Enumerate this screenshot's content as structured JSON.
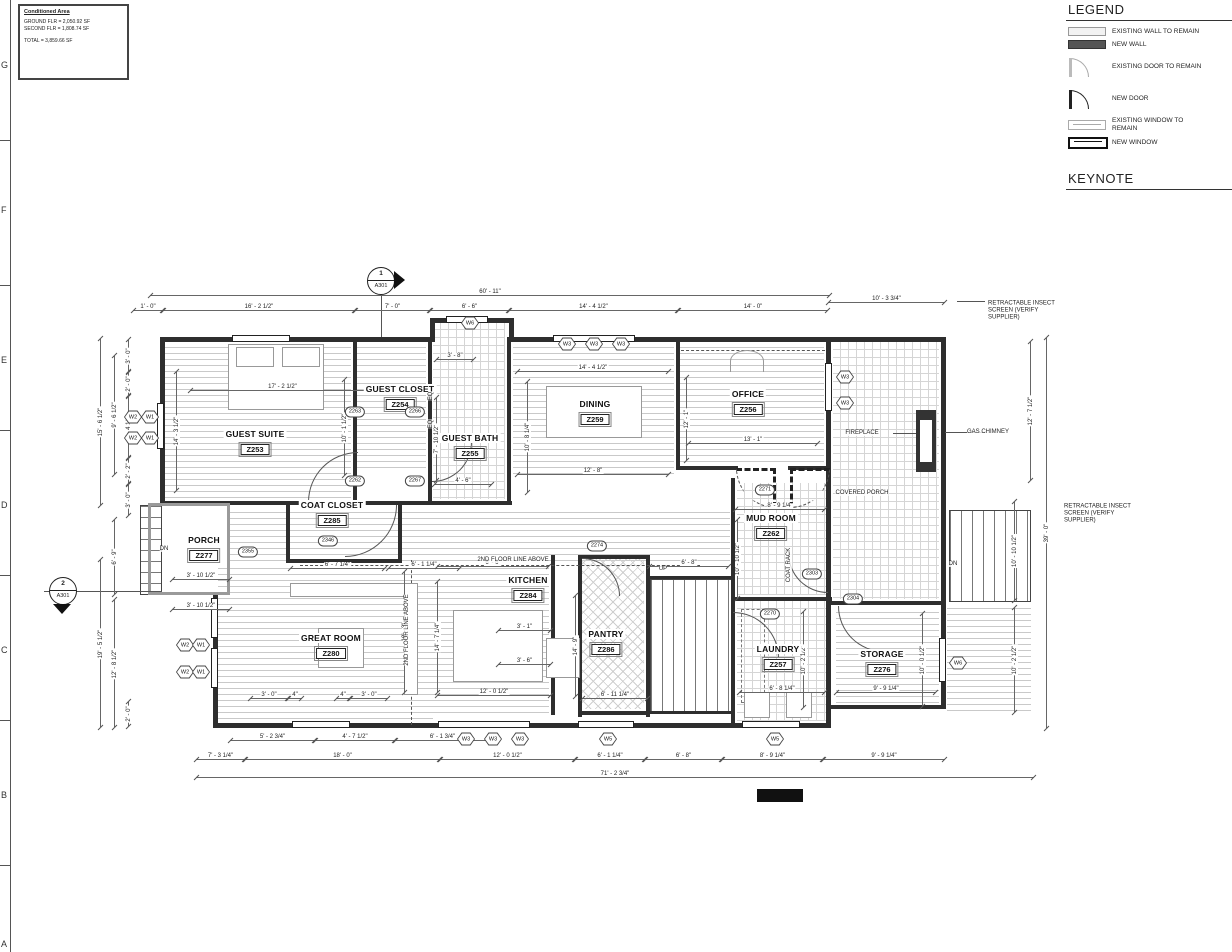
{
  "sheet": {
    "grid_letters": [
      "G",
      "F",
      "E",
      "D",
      "C",
      "B",
      "A"
    ],
    "conditioned_area": {
      "title": "Conditioned Area",
      "lines": [
        "GROUND FLR = 2,050.92 SF",
        "SECOND FLR = 1,808.74 SF"
      ],
      "total": "TOTAL = 3,859.66 SF"
    }
  },
  "legend": {
    "title": "LEGEND",
    "items": [
      {
        "symbol": "existing-wall",
        "label": "EXISTING WALL TO REMAIN"
      },
      {
        "symbol": "new-wall",
        "label": "NEW WALL"
      },
      {
        "symbol": "existing-door",
        "label": "EXISTING DOOR TO REMAIN"
      },
      {
        "symbol": "new-door",
        "label": "NEW DOOR"
      },
      {
        "symbol": "existing-window",
        "label": "EXISTING WINDOW TO\nREMAIN"
      },
      {
        "symbol": "new-window",
        "label": "NEW WINDOW"
      }
    ]
  },
  "keynote": {
    "title": "KEYNOTE"
  },
  "plan": {
    "rooms": [
      {
        "name": "GUEST SUITE",
        "number": "Z253",
        "x": 255,
        "y": 443
      },
      {
        "name": "GUEST CLOSET",
        "number": "Z254",
        "x": 400,
        "y": 398
      },
      {
        "name": "GUEST BATH",
        "number": "Z255",
        "x": 470,
        "y": 447
      },
      {
        "name": "OFFICE",
        "number": "Z256",
        "x": 748,
        "y": 403
      },
      {
        "name": "DINING",
        "number": "Z259",
        "x": 595,
        "y": 413
      },
      {
        "name": "MUD ROOM",
        "number": "Z262",
        "x": 771,
        "y": 527
      },
      {
        "name": "LAUNDRY",
        "number": "Z257",
        "x": 778,
        "y": 658
      },
      {
        "name": "STORAGE",
        "number": "Z276",
        "x": 882,
        "y": 663
      },
      {
        "name": "PORCH",
        "number": "Z277",
        "x": 204,
        "y": 549
      },
      {
        "name": "GREAT ROOM",
        "number": "Z280",
        "x": 331,
        "y": 647
      },
      {
        "name": "KITCHEN",
        "number": "Z284",
        "x": 528,
        "y": 589
      },
      {
        "name": "COAT CLOSET",
        "number": "Z285",
        "x": 332,
        "y": 514
      },
      {
        "name": "PANTRY",
        "number": "Z286",
        "x": 606,
        "y": 643
      }
    ],
    "dimensions": {
      "horizontal": [
        {
          "t": "60' - 11\"",
          "x": 150,
          "y": 288,
          "w": 680
        },
        {
          "t": "1' - 0\"",
          "x": 133,
          "y": 303,
          "w": 30
        },
        {
          "t": "16' - 2 1/2\"",
          "x": 163,
          "y": 303,
          "w": 192
        },
        {
          "t": "7' - 0\"",
          "x": 355,
          "y": 303,
          "w": 75
        },
        {
          "t": "6' - 6\"",
          "x": 430,
          "y": 303,
          "w": 79
        },
        {
          "t": "14' - 4 1/2\"",
          "x": 509,
          "y": 303,
          "w": 169
        },
        {
          "t": "14' - 0\"",
          "x": 678,
          "y": 303,
          "w": 150
        },
        {
          "t": "10' - 3 3/4\"",
          "x": 828,
          "y": 295,
          "w": 117
        },
        {
          "t": "17' - 2 1/2\"",
          "x": 190,
          "y": 383,
          "w": 185
        },
        {
          "t": "14' - 4 1/2\"",
          "x": 517,
          "y": 364,
          "w": 152
        },
        {
          "t": "12' - 8\"",
          "x": 517,
          "y": 467,
          "w": 152
        },
        {
          "t": "13' - 1\"",
          "x": 688,
          "y": 436,
          "w": 130
        },
        {
          "t": "8' - 9 1/4\"",
          "x": 735,
          "y": 502,
          "w": 90
        },
        {
          "t": "3' - 8\"",
          "x": 436,
          "y": 352,
          "w": 38
        },
        {
          "t": "4' - 6\"",
          "x": 434,
          "y": 477,
          "w": 58
        },
        {
          "t": "6' - 7 1/4\"",
          "x": 290,
          "y": 561,
          "w": 95
        },
        {
          "t": "6' - 1 1/4\"",
          "x": 388,
          "y": 561,
          "w": 72
        },
        {
          "t": "3' - 10 1/2\"",
          "x": 172,
          "y": 572,
          "w": 58
        },
        {
          "t": "3' - 10 1/2\"",
          "x": 172,
          "y": 602,
          "w": 58
        },
        {
          "t": "6' - 6\"",
          "x": 437,
          "y": 559,
          "w": 112
        },
        {
          "t": "6' - 8\"",
          "x": 649,
          "y": 559,
          "w": 80
        },
        {
          "t": "3' - 1\"",
          "x": 498,
          "y": 623,
          "w": 53
        },
        {
          "t": "3' - 6\"",
          "x": 498,
          "y": 657,
          "w": 53
        },
        {
          "t": "12' - 0 1/2\"",
          "x": 437,
          "y": 688,
          "w": 114
        },
        {
          "t": "6' - 11 1/4\"",
          "x": 582,
          "y": 691,
          "w": 66
        },
        {
          "t": "6' - 8 1/4\"",
          "x": 739,
          "y": 685,
          "w": 86
        },
        {
          "t": "9' - 9 1/4\"",
          "x": 836,
          "y": 685,
          "w": 100
        },
        {
          "t": "3' - 0\"",
          "x": 250,
          "y": 691,
          "w": 38
        },
        {
          "t": "4\"",
          "x": 288,
          "y": 691,
          "w": 14
        },
        {
          "t": "4\"",
          "x": 336,
          "y": 691,
          "w": 14
        },
        {
          "t": "3' - 0\"",
          "x": 350,
          "y": 691,
          "w": 38
        },
        {
          "t": "5' - 2 3/4\"",
          "x": 230,
          "y": 733,
          "w": 85
        },
        {
          "t": "4' - 7 1/2\"",
          "x": 315,
          "y": 733,
          "w": 80
        },
        {
          "t": "6' - 1 3/4\"",
          "x": 395,
          "y": 733,
          "w": 95
        },
        {
          "t": "7' - 3 1/4\"",
          "x": 196,
          "y": 752,
          "w": 49
        },
        {
          "t": "18' - 0\"",
          "x": 245,
          "y": 752,
          "w": 195
        },
        {
          "t": "12' - 0 1/2\"",
          "x": 440,
          "y": 752,
          "w": 135
        },
        {
          "t": "6' - 1 1/4\"",
          "x": 575,
          "y": 752,
          "w": 70
        },
        {
          "t": "6' - 8\"",
          "x": 645,
          "y": 752,
          "w": 77
        },
        {
          "t": "8' - 9 1/4\"",
          "x": 722,
          "y": 752,
          "w": 101
        },
        {
          "t": "9' - 9 1/4\"",
          "x": 823,
          "y": 752,
          "w": 122
        },
        {
          "t": "71' - 2 3/4\"",
          "x": 196,
          "y": 770,
          "w": 838
        }
      ],
      "vertical": [
        {
          "t": "15' - 6 1/2\"",
          "x": 100,
          "y": 339,
          "h": 166
        },
        {
          "t": "9' - 6 1/2\"",
          "x": 114,
          "y": 356,
          "h": 118
        },
        {
          "t": "3' - 0\"",
          "x": 128,
          "y": 340,
          "h": 31
        },
        {
          "t": "2' - 0\"",
          "x": 128,
          "y": 373,
          "h": 22
        },
        {
          "t": "5' - 4 1/2\"",
          "x": 128,
          "y": 397,
          "h": 60
        },
        {
          "t": "2' - 2\"",
          "x": 128,
          "y": 459,
          "h": 24
        },
        {
          "t": "3' - 0\"",
          "x": 128,
          "y": 485,
          "h": 30
        },
        {
          "t": "6' - 9\"",
          "x": 114,
          "y": 520,
          "h": 74
        },
        {
          "t": "19' - 5 1/2\"",
          "x": 100,
          "y": 560,
          "h": 167
        },
        {
          "t": "12' - 8 1/2\"",
          "x": 114,
          "y": 600,
          "h": 127
        },
        {
          "t": "2' - 0\"",
          "x": 128,
          "y": 702,
          "h": 24
        },
        {
          "t": "14' - 3 1/2\"",
          "x": 176,
          "y": 372,
          "h": 118
        },
        {
          "t": "10' - 1 1/2\"",
          "x": 344,
          "y": 380,
          "h": 95
        },
        {
          "t": "7' - 10 1/2\"",
          "x": 436,
          "y": 398,
          "h": 82
        },
        {
          "t": "10' - 8 1/4\"",
          "x": 527,
          "y": 382,
          "h": 110
        },
        {
          "t": "12' - 1\"",
          "x": 686,
          "y": 378,
          "h": 82
        },
        {
          "t": "10' - 10 1/2\"",
          "x": 737,
          "y": 520,
          "h": 78
        },
        {
          "t": "14' - 9\"",
          "x": 575,
          "y": 596,
          "h": 100
        },
        {
          "t": "18' - 3\"",
          "x": 404,
          "y": 572,
          "h": 120
        },
        {
          "t": "14' - 7 1/4\"",
          "x": 437,
          "y": 582,
          "h": 110
        },
        {
          "t": "10' - 2 1/2\"",
          "x": 803,
          "y": 612,
          "h": 95
        },
        {
          "t": "10' - 0 1/2\"",
          "x": 922,
          "y": 614,
          "h": 92
        },
        {
          "t": "12' - 7 1/2\"",
          "x": 1030,
          "y": 342,
          "h": 138
        },
        {
          "t": "39' - 0\"",
          "x": 1046,
          "y": 338,
          "h": 390
        },
        {
          "t": "10' - 10 1/2\"",
          "x": 1014,
          "y": 502,
          "h": 98
        },
        {
          "t": "10' - 2 1/2\"",
          "x": 1014,
          "y": 608,
          "h": 104
        }
      ]
    },
    "keynote_tags": [
      {
        "id": "2263",
        "x": 355,
        "y": 412
      },
      {
        "id": "2266",
        "x": 415,
        "y": 412
      },
      {
        "id": "2262",
        "x": 355,
        "y": 481
      },
      {
        "id": "2267",
        "x": 415,
        "y": 481
      },
      {
        "id": "2346",
        "x": 328,
        "y": 541
      },
      {
        "id": "2355",
        "x": 248,
        "y": 552
      },
      {
        "id": "2274",
        "x": 597,
        "y": 546
      },
      {
        "id": "2271",
        "x": 765,
        "y": 490
      },
      {
        "id": "2303",
        "x": 812,
        "y": 574
      },
      {
        "id": "2304",
        "x": 853,
        "y": 599
      },
      {
        "id": "2270",
        "x": 770,
        "y": 614
      }
    ],
    "window_tags": [
      {
        "id": "W6",
        "x": 470,
        "y": 323
      },
      {
        "id": "W3",
        "x": 567,
        "y": 344
      },
      {
        "id": "W3",
        "x": 594,
        "y": 344
      },
      {
        "id": "W3",
        "x": 621,
        "y": 344
      },
      {
        "id": "W3",
        "x": 845,
        "y": 377
      },
      {
        "id": "W3",
        "x": 845,
        "y": 403
      },
      {
        "id": "W2",
        "x": 133,
        "y": 417
      },
      {
        "id": "W1",
        "x": 150,
        "y": 417
      },
      {
        "id": "W2",
        "x": 133,
        "y": 438
      },
      {
        "id": "W1",
        "x": 150,
        "y": 438
      },
      {
        "id": "W2",
        "x": 185,
        "y": 645
      },
      {
        "id": "W1",
        "x": 201,
        "y": 645
      },
      {
        "id": "W2",
        "x": 185,
        "y": 672
      },
      {
        "id": "W1",
        "x": 201,
        "y": 672
      },
      {
        "id": "W3",
        "x": 466,
        "y": 739
      },
      {
        "id": "W3",
        "x": 493,
        "y": 739
      },
      {
        "id": "W3",
        "x": 520,
        "y": 739
      },
      {
        "id": "W5",
        "x": 608,
        "y": 739
      },
      {
        "id": "W5",
        "x": 775,
        "y": 739
      },
      {
        "id": "W6",
        "x": 958,
        "y": 663
      }
    ],
    "annotations": [
      {
        "t": "RETRACTABLE INSECT\nSCREEN (VERIFY\nSUPPLIER)",
        "x": 988,
        "y": 311,
        "cls": "ml"
      },
      {
        "t": "RETRACTABLE INSECT\nSCREEN (VERIFY\nSUPPLIER)",
        "x": 1064,
        "y": 514,
        "cls": "ml"
      },
      {
        "t": "GAS CHIMNEY",
        "x": 988,
        "y": 432
      },
      {
        "t": "FIREPLACE",
        "x": 862,
        "y": 433
      },
      {
        "t": "COVERED PORCH",
        "x": 862,
        "y": 493
      },
      {
        "t": "COAT RACK",
        "x": 789,
        "y": 565,
        "cls": "rot"
      },
      {
        "t": "2ND FLOOR LINE ABOVE",
        "x": 513,
        "y": 560
      },
      {
        "t": "2ND FLOOR LINE ABOVE",
        "x": 407,
        "y": 630,
        "cls": "rot"
      },
      {
        "t": "UP",
        "x": 663,
        "y": 569
      },
      {
        "t": "DN",
        "x": 953,
        "y": 564
      },
      {
        "t": "DN",
        "x": 164,
        "y": 549
      },
      {
        "t": "EQ",
        "x": 431,
        "y": 396,
        "cls": "rot"
      },
      {
        "t": "EQ",
        "x": 431,
        "y": 424,
        "cls": "rot"
      }
    ],
    "section_markers": [
      {
        "num": "1",
        "sheet": "A301",
        "x": 381,
        "y": 281,
        "dir": "right"
      },
      {
        "num": "2",
        "sheet": "A301",
        "x": 63,
        "y": 591,
        "dir": "down"
      }
    ]
  }
}
